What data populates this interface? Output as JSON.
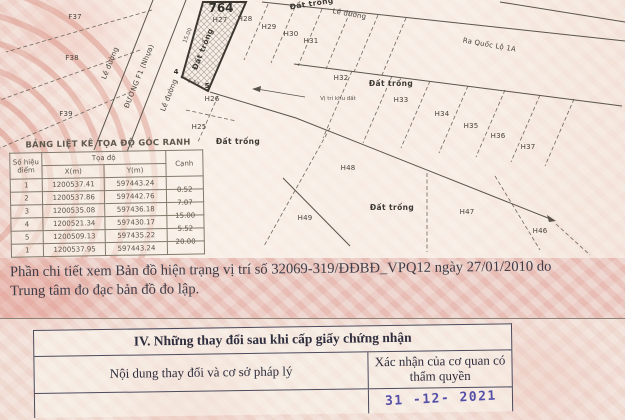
{
  "map": {
    "plot_number": "764",
    "labels": [
      {
        "text": "Đất trống"
      },
      {
        "text": "F37"
      },
      {
        "text": "F38"
      },
      {
        "text": "F39"
      },
      {
        "text": "Lề đường"
      },
      {
        "text": "ĐƯỜNG F1 (Nhựa)"
      },
      {
        "text": "Lề đường"
      },
      {
        "text": "Đất trống"
      },
      {
        "text": "15.00"
      },
      {
        "text": "764"
      },
      {
        "text": "H27"
      },
      {
        "text": "H28"
      },
      {
        "text": "H29"
      },
      {
        "text": "H30"
      },
      {
        "text": "H31"
      },
      {
        "text": "Lề đường"
      },
      {
        "text": "Ra Quốc Lộ 1A"
      },
      {
        "text": "H32"
      },
      {
        "text": "Vị trí khu đất"
      },
      {
        "text": "Đất trống"
      },
      {
        "text": "H33"
      },
      {
        "text": "H34"
      },
      {
        "text": "H35"
      },
      {
        "text": "H36"
      },
      {
        "text": "H37"
      },
      {
        "text": "4"
      },
      {
        "text": "5"
      },
      {
        "text": "H26"
      },
      {
        "text": "H25"
      },
      {
        "text": "Đất trống"
      },
      {
        "text": "H48"
      },
      {
        "text": "H49"
      },
      {
        "text": "Đất trống"
      },
      {
        "text": "H47"
      },
      {
        "text": "H46"
      },
      {
        "text": "5.52"
      }
    ]
  },
  "coord_table": {
    "title": "BẢNG LIỆT KÊ TỌA ĐỘ GÓC RANH",
    "headers": {
      "point": "Số hiệu điểm",
      "group": "Tọa độ",
      "x": "X(m)",
      "y": "Y(m)",
      "edge": "Cạnh"
    },
    "rows": [
      {
        "point": "1",
        "x": "1200537.41",
        "y": "597443.24",
        "edge": ""
      },
      {
        "point": "2",
        "x": "1200537.86",
        "y": "597442.76",
        "edge": "0.52"
      },
      {
        "point": "3",
        "x": "1200535.08",
        "y": "597436.18",
        "edge": "7.07"
      },
      {
        "point": "4",
        "x": "1200521.34",
        "y": "597430.17",
        "edge": "15.00"
      },
      {
        "point": "5",
        "x": "1200509.13",
        "y": "597435.22",
        "edge": "5.52"
      },
      {
        "point": "1",
        "x": "1200537.95",
        "y": "597443.24",
        "edge": "20.00"
      }
    ]
  },
  "note": {
    "line1": "Phần chi tiết xem Bản đồ hiện trạng vị trí số 32069-319/ĐĐBĐ_VPQ12 ngày 27/01/2010 do",
    "line2": "Trung tâm đo đạc bản đồ đo lập."
  },
  "section4": {
    "title": "IV. Những thay đổi sau khi cấp giấy chứng nhận",
    "col1": "Nội dung thay đổi và cơ sở pháp lý",
    "col2": "Xác nhận của cơ quan có thẩm quyền",
    "stamp_date": "31 -12- 2021"
  },
  "colors": {
    "paper_pink": "#ecd2cb",
    "map_line": "#5a544c",
    "stamp_ink": "#534fa8"
  }
}
